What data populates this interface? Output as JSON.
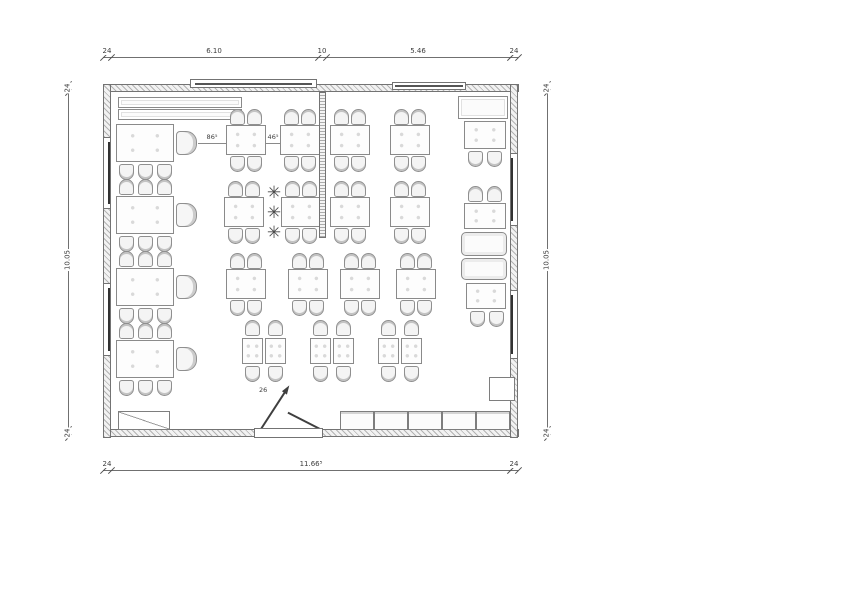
{
  "labels": {
    "gap_a": "86⁵",
    "gap_b": "46⁵",
    "door": "26"
  },
  "colors": {
    "line": "#707070",
    "wall_hatch": "#b3b3b3",
    "text": "#3d3d3d"
  },
  "dims": [
    {
      "o": "h",
      "x": 103,
      "y": 57,
      "len": 415,
      "stations": [
        103,
        111,
        318,
        326,
        510,
        518
      ],
      "labels": [
        {
          "v": "24",
          "p": 107
        },
        {
          "v": "6.10",
          "p": 214
        },
        {
          "v": "10",
          "p": 322
        },
        {
          "v": "5.46",
          "p": 418
        },
        {
          "v": "24",
          "p": 514
        }
      ]
    },
    {
      "o": "h",
      "x": 103,
      "y": 470,
      "len": 415,
      "stations": [
        103,
        111,
        510,
        518
      ],
      "labels": [
        {
          "v": "24",
          "p": 107
        },
        {
          "v": "11.66⁵",
          "p": 311
        },
        {
          "v": "24",
          "p": 514
        }
      ]
    },
    {
      "o": "v",
      "x": 68,
      "y": 84,
      "len": 353,
      "stations": [
        84,
        92,
        429,
        437
      ],
      "labels": [
        {
          "v": "24",
          "p": 88
        },
        {
          "v": "10.05",
          "p": 260
        },
        {
          "v": "24",
          "p": 433
        }
      ]
    },
    {
      "o": "v",
      "x": 547,
      "y": 84,
      "len": 353,
      "stations": [
        84,
        92,
        429,
        437
      ],
      "labels": [
        {
          "v": "24",
          "p": 88
        },
        {
          "v": "10.05",
          "p": 260
        },
        {
          "v": "24",
          "p": 433
        }
      ]
    }
  ],
  "gap_dims": [
    {
      "v": "86⁵",
      "x1": 198,
      "x2": 226,
      "y": 143,
      "lx": 212,
      "ly": 134
    },
    {
      "v": "46⁵",
      "x1": 266,
      "x2": 280,
      "y": 143,
      "lx": 273,
      "ly": 134
    }
  ],
  "door_label": {
    "v": "26",
    "x": 259,
    "y": 387
  },
  "furniture": {
    "items": [
      {
        "t": "bench",
        "x": 118,
        "y": 97,
        "w": 124,
        "h": 11
      },
      {
        "t": "bench",
        "x": 118,
        "y": 109,
        "w": 124,
        "h": 11
      },
      {
        "t": "bench",
        "x": 458,
        "y": 96,
        "w": 50,
        "h": 23
      },
      {
        "t": "table",
        "x": 116,
        "y": 124,
        "w": 58,
        "h": 38
      },
      {
        "t": "table",
        "x": 116,
        "y": 196,
        "w": 58,
        "h": 38
      },
      {
        "t": "table",
        "x": 116,
        "y": 268,
        "w": 58,
        "h": 38
      },
      {
        "t": "table",
        "x": 116,
        "y": 340,
        "w": 58,
        "h": 38
      },
      {
        "t": "armchair",
        "x": 176,
        "y": 131,
        "w": 21,
        "h": 24
      },
      {
        "t": "armchair",
        "x": 176,
        "y": 203,
        "w": 21,
        "h": 24
      },
      {
        "t": "armchair",
        "x": 176,
        "y": 275,
        "w": 21,
        "h": 24
      },
      {
        "t": "armchair",
        "x": 176,
        "y": 347,
        "w": 21,
        "h": 24
      },
      {
        "t": "chair",
        "x": 119,
        "y": 164,
        "r": 180
      },
      {
        "t": "chair",
        "x": 138,
        "y": 164,
        "r": 180
      },
      {
        "t": "chair",
        "x": 157,
        "y": 164,
        "r": 180
      },
      {
        "t": "chair",
        "x": 119,
        "y": 236,
        "r": 180
      },
      {
        "t": "chair",
        "x": 138,
        "y": 236,
        "r": 180
      },
      {
        "t": "chair",
        "x": 157,
        "y": 236,
        "r": 180
      },
      {
        "t": "chair",
        "x": 119,
        "y": 308,
        "r": 180
      },
      {
        "t": "chair",
        "x": 138,
        "y": 308,
        "r": 180
      },
      {
        "t": "chair",
        "x": 157,
        "y": 308,
        "r": 180
      },
      {
        "t": "chair",
        "x": 119,
        "y": 380,
        "r": 180
      },
      {
        "t": "chair",
        "x": 138,
        "y": 380,
        "r": 180
      },
      {
        "t": "chair",
        "x": 157,
        "y": 380,
        "r": 180
      },
      {
        "t": "chair",
        "x": 119,
        "y": 179
      },
      {
        "t": "chair",
        "x": 138,
        "y": 179
      },
      {
        "t": "chair",
        "x": 157,
        "y": 179
      },
      {
        "t": "chair",
        "x": 119,
        "y": 251
      },
      {
        "t": "chair",
        "x": 138,
        "y": 251
      },
      {
        "t": "chair",
        "x": 157,
        "y": 251
      },
      {
        "t": "chair",
        "x": 119,
        "y": 323
      },
      {
        "t": "chair",
        "x": 138,
        "y": 323
      },
      {
        "t": "chair",
        "x": 157,
        "y": 323
      },
      {
        "t": "table",
        "x": 226,
        "y": 125,
        "w": 40,
        "h": 30
      },
      {
        "t": "table",
        "x": 280,
        "y": 125,
        "w": 40,
        "h": 30
      },
      {
        "t": "table",
        "x": 330,
        "y": 125,
        "w": 40,
        "h": 30
      },
      {
        "t": "table",
        "x": 390,
        "y": 125,
        "w": 40,
        "h": 30
      },
      {
        "t": "chair",
        "x": 230,
        "y": 109
      },
      {
        "t": "chair",
        "x": 247,
        "y": 109
      },
      {
        "t": "chair",
        "x": 284,
        "y": 109
      },
      {
        "t": "chair",
        "x": 301,
        "y": 109
      },
      {
        "t": "chair",
        "x": 334,
        "y": 109
      },
      {
        "t": "chair",
        "x": 351,
        "y": 109
      },
      {
        "t": "chair",
        "x": 394,
        "y": 109
      },
      {
        "t": "chair",
        "x": 411,
        "y": 109
      },
      {
        "t": "chair",
        "x": 230,
        "y": 156,
        "r": 180
      },
      {
        "t": "chair",
        "x": 247,
        "y": 156,
        "r": 180
      },
      {
        "t": "chair",
        "x": 284,
        "y": 156,
        "r": 180
      },
      {
        "t": "chair",
        "x": 301,
        "y": 156,
        "r": 180
      },
      {
        "t": "chair",
        "x": 334,
        "y": 156,
        "r": 180
      },
      {
        "t": "chair",
        "x": 351,
        "y": 156,
        "r": 180
      },
      {
        "t": "chair",
        "x": 394,
        "y": 156,
        "r": 180
      },
      {
        "t": "chair",
        "x": 411,
        "y": 156,
        "r": 180
      },
      {
        "t": "table",
        "x": 224,
        "y": 197,
        "w": 40,
        "h": 30
      },
      {
        "t": "table",
        "x": 281,
        "y": 197,
        "w": 40,
        "h": 30
      },
      {
        "t": "table",
        "x": 330,
        "y": 197,
        "w": 40,
        "h": 30
      },
      {
        "t": "table",
        "x": 390,
        "y": 197,
        "w": 40,
        "h": 30
      },
      {
        "t": "chair",
        "x": 228,
        "y": 181
      },
      {
        "t": "chair",
        "x": 245,
        "y": 181
      },
      {
        "t": "chair",
        "x": 285,
        "y": 181
      },
      {
        "t": "chair",
        "x": 302,
        "y": 181
      },
      {
        "t": "chair",
        "x": 334,
        "y": 181
      },
      {
        "t": "chair",
        "x": 351,
        "y": 181
      },
      {
        "t": "chair",
        "x": 394,
        "y": 181
      },
      {
        "t": "chair",
        "x": 411,
        "y": 181
      },
      {
        "t": "chair",
        "x": 228,
        "y": 228,
        "r": 180
      },
      {
        "t": "chair",
        "x": 245,
        "y": 228,
        "r": 180
      },
      {
        "t": "chair",
        "x": 285,
        "y": 228,
        "r": 180
      },
      {
        "t": "chair",
        "x": 302,
        "y": 228,
        "r": 180
      },
      {
        "t": "chair",
        "x": 334,
        "y": 228,
        "r": 180
      },
      {
        "t": "chair",
        "x": 351,
        "y": 228,
        "r": 180
      },
      {
        "t": "chair",
        "x": 394,
        "y": 228,
        "r": 180
      },
      {
        "t": "chair",
        "x": 411,
        "y": 228,
        "r": 180
      },
      {
        "t": "table",
        "x": 226,
        "y": 269,
        "w": 40,
        "h": 30
      },
      {
        "t": "table",
        "x": 288,
        "y": 269,
        "w": 40,
        "h": 30
      },
      {
        "t": "table",
        "x": 340,
        "y": 269,
        "w": 40,
        "h": 30
      },
      {
        "t": "table",
        "x": 396,
        "y": 269,
        "w": 40,
        "h": 30
      },
      {
        "t": "chair",
        "x": 230,
        "y": 253
      },
      {
        "t": "chair",
        "x": 247,
        "y": 253
      },
      {
        "t": "chair",
        "x": 292,
        "y": 253
      },
      {
        "t": "chair",
        "x": 309,
        "y": 253
      },
      {
        "t": "chair",
        "x": 344,
        "y": 253
      },
      {
        "t": "chair",
        "x": 361,
        "y": 253
      },
      {
        "t": "chair",
        "x": 400,
        "y": 253
      },
      {
        "t": "chair",
        "x": 417,
        "y": 253
      },
      {
        "t": "chair",
        "x": 230,
        "y": 300,
        "r": 180
      },
      {
        "t": "chair",
        "x": 247,
        "y": 300,
        "r": 180
      },
      {
        "t": "chair",
        "x": 292,
        "y": 300,
        "r": 180
      },
      {
        "t": "chair",
        "x": 309,
        "y": 300,
        "r": 180
      },
      {
        "t": "chair",
        "x": 344,
        "y": 300,
        "r": 180
      },
      {
        "t": "chair",
        "x": 361,
        "y": 300,
        "r": 180
      },
      {
        "t": "chair",
        "x": 400,
        "y": 300,
        "r": 180
      },
      {
        "t": "chair",
        "x": 417,
        "y": 300,
        "r": 180
      },
      {
        "t": "table",
        "x": 242,
        "y": 338,
        "w": 21,
        "h": 26
      },
      {
        "t": "table",
        "x": 265,
        "y": 338,
        "w": 21,
        "h": 26
      },
      {
        "t": "table",
        "x": 310,
        "y": 338,
        "w": 21,
        "h": 26
      },
      {
        "t": "table",
        "x": 333,
        "y": 338,
        "w": 21,
        "h": 26
      },
      {
        "t": "table",
        "x": 378,
        "y": 338,
        "w": 21,
        "h": 26
      },
      {
        "t": "table",
        "x": 401,
        "y": 338,
        "w": 21,
        "h": 26
      },
      {
        "t": "chair",
        "x": 245,
        "y": 320
      },
      {
        "t": "chair",
        "x": 268,
        "y": 320
      },
      {
        "t": "chair",
        "x": 313,
        "y": 320
      },
      {
        "t": "chair",
        "x": 336,
        "y": 320
      },
      {
        "t": "chair",
        "x": 381,
        "y": 320
      },
      {
        "t": "chair",
        "x": 404,
        "y": 320
      },
      {
        "t": "chair",
        "x": 245,
        "y": 366,
        "r": 180
      },
      {
        "t": "chair",
        "x": 268,
        "y": 366,
        "r": 180
      },
      {
        "t": "chair",
        "x": 313,
        "y": 366,
        "r": 180
      },
      {
        "t": "chair",
        "x": 336,
        "y": 366,
        "r": 180
      },
      {
        "t": "chair",
        "x": 381,
        "y": 366,
        "r": 180
      },
      {
        "t": "chair",
        "x": 404,
        "y": 366,
        "r": 180
      },
      {
        "t": "table",
        "x": 464,
        "y": 121,
        "w": 42,
        "h": 28
      },
      {
        "t": "chair",
        "x": 468,
        "y": 151,
        "r": 180
      },
      {
        "t": "chair",
        "x": 487,
        "y": 151,
        "r": 180
      },
      {
        "t": "chair",
        "x": 468,
        "y": 186
      },
      {
        "t": "chair",
        "x": 487,
        "y": 186
      },
      {
        "t": "table",
        "x": 464,
        "y": 203,
        "w": 42,
        "h": 26
      },
      {
        "t": "booth",
        "x": 461,
        "y": 232,
        "w": 46,
        "h": 24
      },
      {
        "t": "booth",
        "x": 461,
        "y": 258,
        "w": 46,
        "h": 22
      },
      {
        "t": "table",
        "x": 466,
        "y": 283,
        "w": 40,
        "h": 26
      },
      {
        "t": "chair",
        "x": 470,
        "y": 311,
        "r": 180
      },
      {
        "t": "chair",
        "x": 489,
        "y": 311,
        "r": 180
      },
      {
        "t": "closet",
        "x": 489,
        "y": 377,
        "w": 26,
        "h": 24
      },
      {
        "t": "counter",
        "x": 340,
        "y": 411,
        "w": 34,
        "h": 19
      },
      {
        "t": "counter",
        "x": 374,
        "y": 411,
        "w": 34,
        "h": 19
      },
      {
        "t": "counter",
        "x": 408,
        "y": 411,
        "w": 34,
        "h": 19
      },
      {
        "t": "counter",
        "x": 442,
        "y": 411,
        "w": 34,
        "h": 19
      },
      {
        "t": "counter",
        "x": 476,
        "y": 411,
        "w": 34,
        "h": 19
      },
      {
        "t": "shelf",
        "x": 118,
        "y": 411,
        "w": 52,
        "h": 19
      },
      {
        "t": "plant",
        "x": 264,
        "y": 183
      },
      {
        "t": "plant",
        "x": 264,
        "y": 203
      },
      {
        "t": "plant",
        "x": 264,
        "y": 223
      },
      {
        "t": "winL",
        "x": 103,
        "y": 137,
        "w": 8,
        "h": 72
      },
      {
        "t": "winL",
        "x": 103,
        "y": 283,
        "w": 8,
        "h": 73
      },
      {
        "t": "winR",
        "x": 510,
        "y": 153,
        "w": 8,
        "h": 73
      },
      {
        "t": "winR",
        "x": 510,
        "y": 290,
        "w": 8,
        "h": 69
      },
      {
        "t": "winT",
        "x": 190,
        "y": 79,
        "w": 127,
        "h": 9
      },
      {
        "t": "winT",
        "x": 392,
        "y": 82,
        "w": 74,
        "h": 8
      },
      {
        "t": "partition",
        "x": 319,
        "y": 92,
        "w": 7,
        "h": 146
      },
      {
        "t": "sill",
        "x": 254,
        "y": 428,
        "w": 69,
        "h": 10
      }
    ]
  }
}
